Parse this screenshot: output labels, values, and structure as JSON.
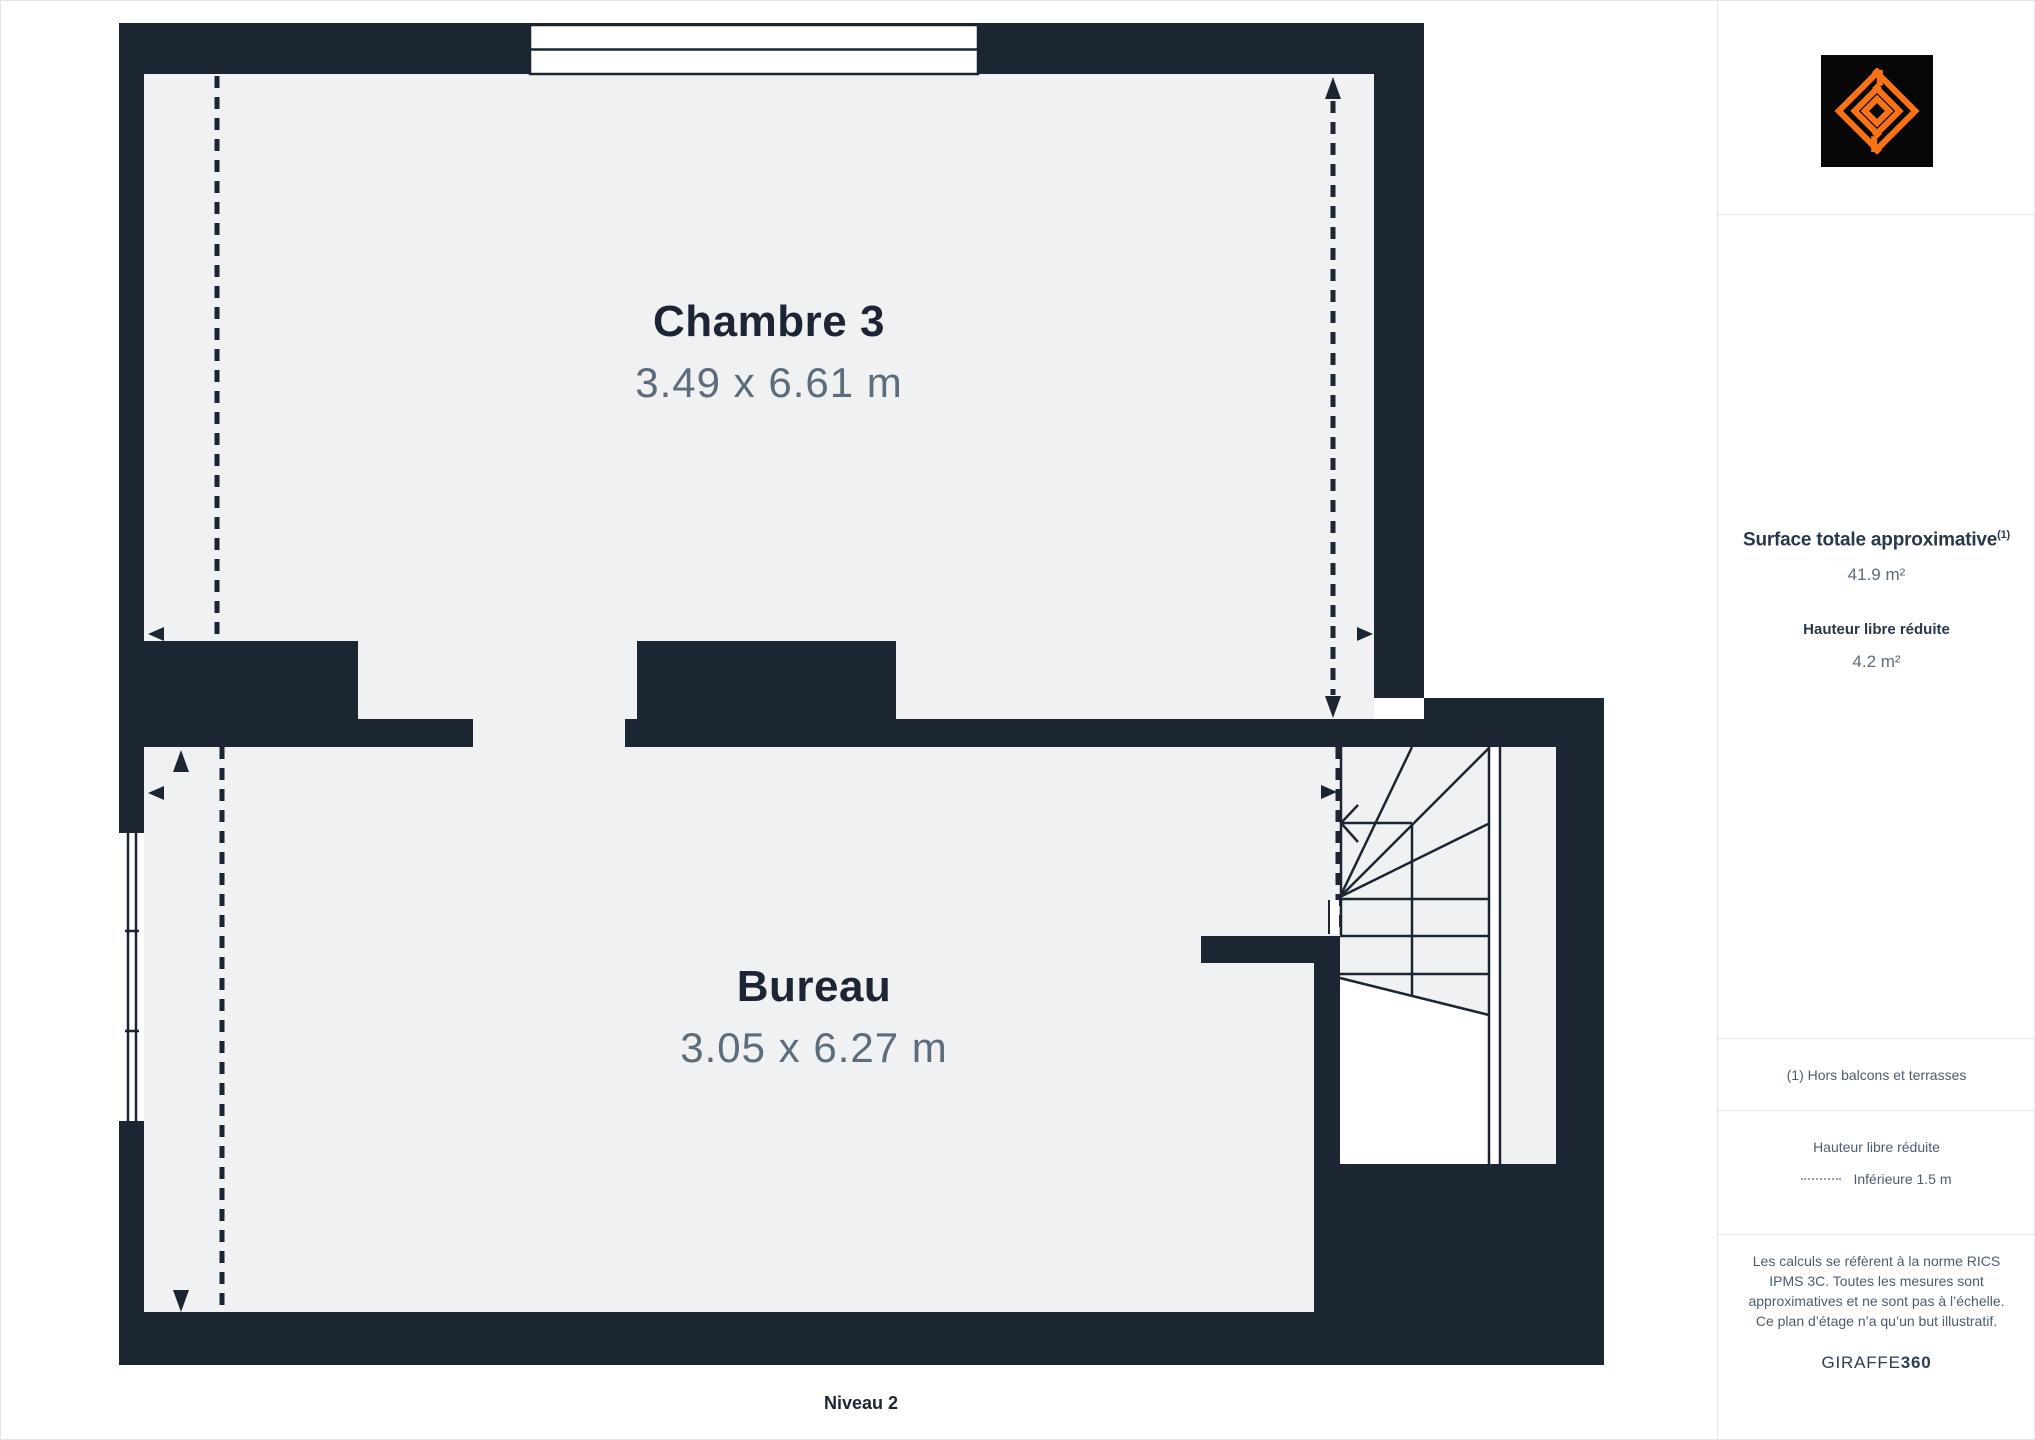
{
  "plan": {
    "level_label": "Niveau 2",
    "rooms": [
      {
        "name": "Chambre 3",
        "dimensions": "3.49 x 6.61 m"
      },
      {
        "name": "Bureau",
        "dimensions": "3.05 x 6.27 m"
      }
    ]
  },
  "sidebar": {
    "surface_title": "Surface totale approximative",
    "surface_sup": "(1)",
    "surface_value": "41.9 m²",
    "reduced_height_title": "Hauteur libre réduite",
    "reduced_height_value": "4.2 m²",
    "footnote": "(1) Hors balcons et terrasses",
    "legend_title": "Hauteur libre réduite",
    "legend_item": "Inférieure 1.5 m",
    "disclaimer": "Les calculs se réfèrent à la norme RICS IPMS 3C. Toutes les mesures sont approximatives et ne sont pas à l’échelle. Ce plan d’étage n’a qu’un but illustratif.",
    "brand": "GIRAFFE",
    "brand_bold": "360"
  },
  "colors": {
    "wall_navy": "#1C2532",
    "floor_gray": "#F0F1F2",
    "text_navy": "#1D2534",
    "text_muted": "#5D6C7B",
    "accent_orange": "#F97316",
    "border_gray": "#E4E7EA"
  }
}
